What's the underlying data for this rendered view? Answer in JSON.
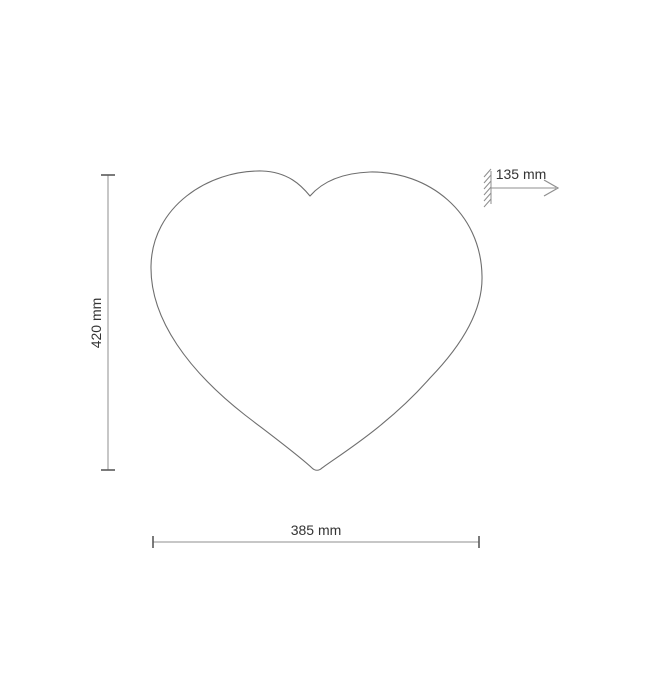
{
  "diagram": {
    "type": "technical-dimension-drawing",
    "subject": "heart-shaped wall lamp, front view with mounting depth",
    "dimensions": {
      "height": {
        "label": "420 mm",
        "orientation": "vertical"
      },
      "width": {
        "label": "385 mm",
        "orientation": "horizontal"
      },
      "depth": {
        "label": "135 mm",
        "orientation": "horizontal"
      }
    },
    "colors": {
      "background": "#ffffff",
      "outline": "#6e6e6e",
      "dimension_line": "#8f8f8f",
      "tick": "#5a5a5a",
      "text": "#333333"
    }
  }
}
